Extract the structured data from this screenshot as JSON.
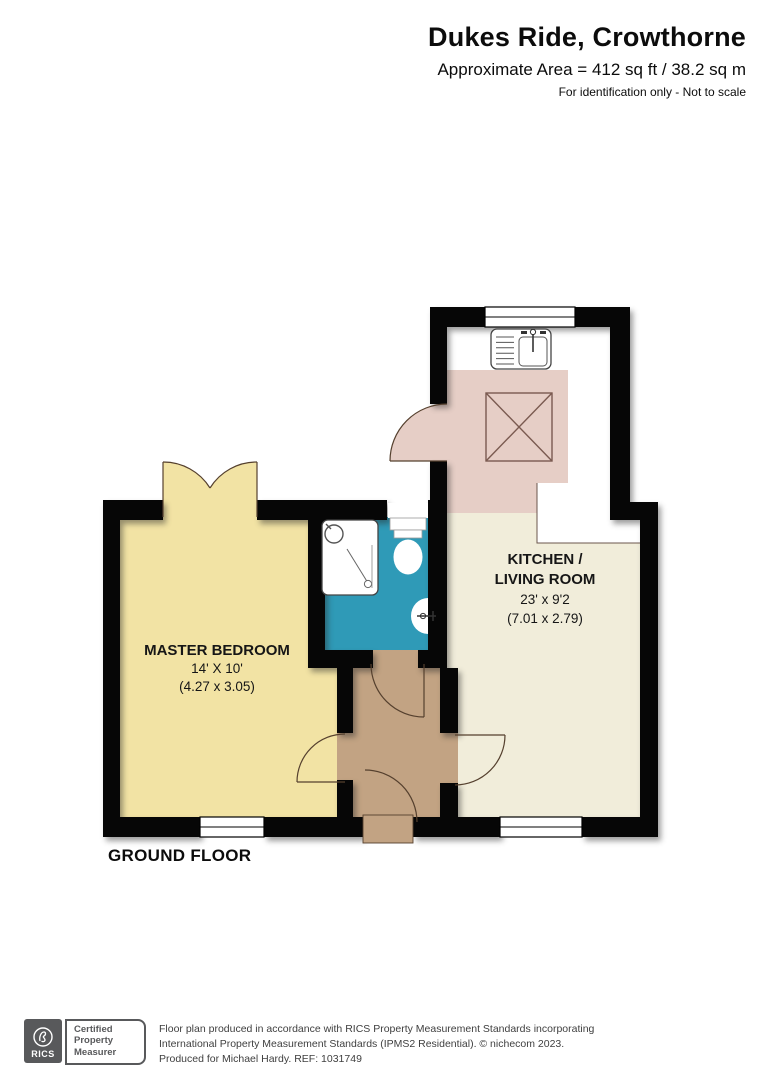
{
  "header": {
    "title": "Dukes Ride, Crowthorne",
    "area": "Approximate Area = 412 sq ft / 38.2 sq m",
    "disclaimer": "For identification only - Not to scale"
  },
  "plan": {
    "floor_label": "GROUND FLOOR",
    "rooms": {
      "master_bedroom": {
        "name": "MASTER BEDROOM",
        "dims_imperial": "14' X 10'",
        "dims_metric": "(4.27 x 3.05)"
      },
      "kitchen_living": {
        "name_line1": "KITCHEN /",
        "name_line2": "LIVING ROOM",
        "dims_imperial": "23' x 9'2",
        "dims_metric": "(7.01 x 2.79)"
      }
    },
    "colors": {
      "bedroom": "#f2e3a4",
      "kitchen_floor": "#f1edda",
      "kitchen_pink": "#e6cec6",
      "bathroom": "#2f9ab7",
      "hallway": "#c2a383",
      "wall": "#060606",
      "counter": "#ffffff"
    }
  },
  "footer": {
    "rics_label": "RICS",
    "badge": [
      "Certified",
      "Property",
      "Measurer"
    ],
    "lines": [
      "Floor plan produced in accordance with RICS Property Measurement Standards incorporating",
      "International Property Measurement Standards (IPMS2 Residential).   © nichecom 2023.",
      "Produced for Michael Hardy.   REF:  1031749"
    ]
  }
}
